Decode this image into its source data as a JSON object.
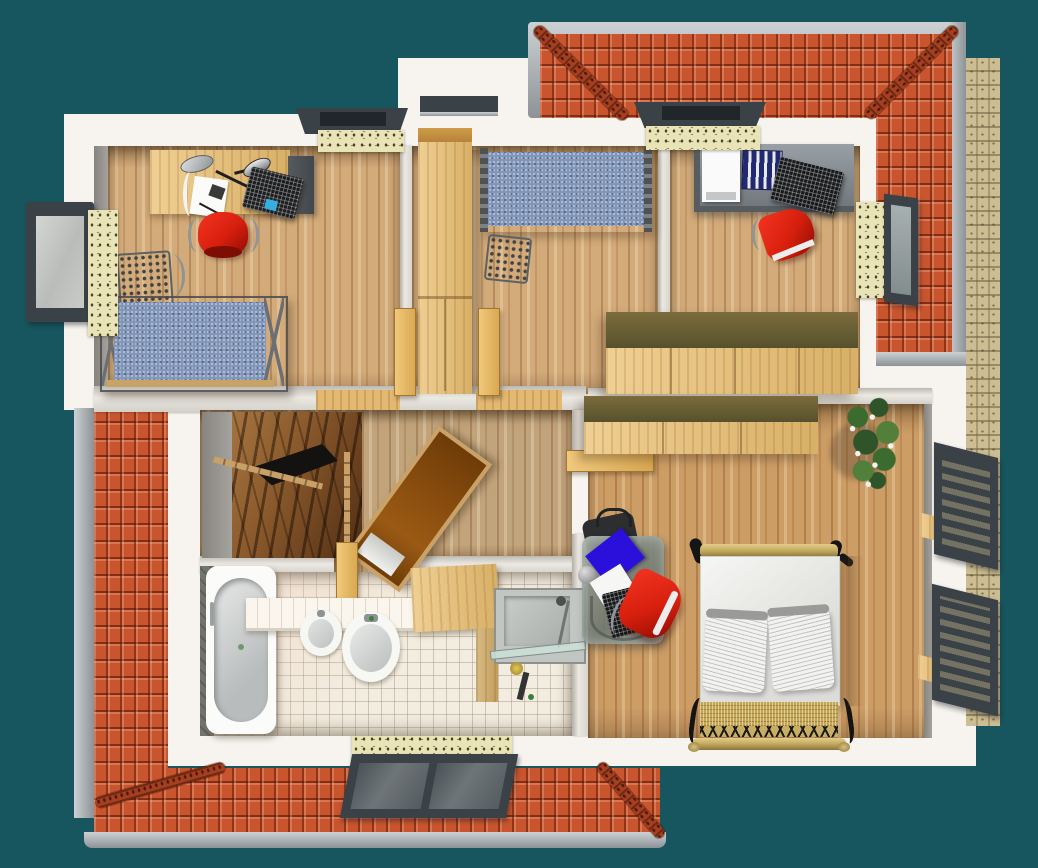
{
  "scene": {
    "title": "upper-floor-plan-3d-render",
    "view": "top-down",
    "rooms": [
      {
        "id": "bedroom-west",
        "furniture": [
          "wooden-desk",
          "desk-lamp",
          "laptop",
          "paper-sheet",
          "tray-dish",
          "drawer-unit",
          "red-swivel-chair",
          "metal-waste-basket",
          "single-bed-blue",
          "casement-window-west",
          "roof-window-north-west"
        ]
      },
      {
        "id": "bedroom-middle",
        "furniture": [
          "tall-wardrobe",
          "single-bed-blue",
          "metal-waste-basket"
        ]
      },
      {
        "id": "bedroom-east",
        "furniture": [
          "gray-desk",
          "paper-tray",
          "binder-row",
          "keyboard",
          "red-swivel-chair",
          "low-wardrobe",
          "casement-window-east",
          "roof-window-north-east"
        ]
      },
      {
        "id": "hallway",
        "furniture": [
          "winder-staircase",
          "stair-railing",
          "lounger-chair",
          "open-door-west",
          "open-door-middle"
        ]
      },
      {
        "id": "bathroom",
        "furniture": [
          "bathtub",
          "vanity-counter",
          "bidet",
          "washbasin",
          "wooden-bench",
          "shower-tray",
          "glass-panel",
          "floor-faucet",
          "open-door",
          "roof-window-south"
        ]
      },
      {
        "id": "master-bedroom",
        "furniture": [
          "low-wardrobe",
          "potted-plant",
          "glass-desk",
          "blue-folder",
          "paper-sheet",
          "laptop",
          "desk-sphere",
          "dark-bag",
          "red-swivel-chair",
          "double-bed-white",
          "pillow-left",
          "pillow-right",
          "casement-window-east-upper",
          "casement-window-east-lower",
          "open-door"
        ]
      }
    ],
    "exterior": [
      "hip-roof-north-east",
      "roof-strip-east",
      "roof-strip-west",
      "roof-strip-south",
      "stone-chimney-east",
      "rain-gutters",
      "dormer-window-south"
    ]
  },
  "colors": {
    "bg": "#17565f",
    "roof": "#c8552e",
    "ridge": "#a63f1f",
    "gutter_hi": "#cdd1d4",
    "gutter_lo": "#8c9296",
    "stone": "#cdbd92",
    "wall": "#f7f4ef",
    "frame": "#3b4247",
    "floor": "#d3ab7a",
    "floor_hall": "#c2a47c",
    "floor_bed": "#cd9d66",
    "tile": "#f3ede1",
    "wood": "#eabf70",
    "wardrobe_top": "#56512c",
    "bed_blue": "#8296b9",
    "red": "#d71f0e",
    "desk_gray": "#7d848a",
    "brass": "#c3a95e",
    "plant": "#3c6b30",
    "lounger": "#8a4d0e",
    "speckle": "#e9e3b8"
  }
}
